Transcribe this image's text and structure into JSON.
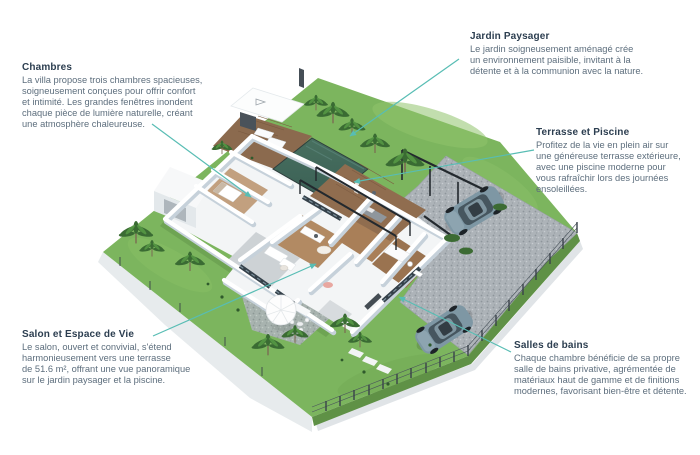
{
  "accent_color": "#58bdb4",
  "heading_color": "#2c3e50",
  "body_color": "#5d6e7d",
  "scene_colors": {
    "grass": "#7cb55e",
    "grass_edge": "#5f9146",
    "gravel": "#adb3b8",
    "pool_water": "#3f665c",
    "deck_wood": "#8b6a4e",
    "house_wall": "#ffffff",
    "glass": "#35414a",
    "car_body": "#7e97a4",
    "cliff": "#e7ebed"
  },
  "annotations": [
    {
      "key": "chambres",
      "title": "Chambres",
      "body": "La villa propose trois chambres spacieuses,\nsoigneusement conçues pour offrir confort\net intimité. Les grandes fenêtres inondent\nchaque pièce de lumière naturelle, créant\nune atmosphère chaleureuse."
    },
    {
      "key": "jardin",
      "title": "Jardin Paysager",
      "body": "Le jardin soigneusement aménagé crée\nun environnement paisible, invitant à la\ndétente et à la communion avec la nature."
    },
    {
      "key": "terrasse",
      "title": "Terrasse et Piscine",
      "body": "Profitez de la vie en plein air sur\nune généreuse terrasse extérieure,\navec une piscine moderne pour\nvous rafraîchir lors des journées\nensoleillées."
    },
    {
      "key": "salon",
      "title": "Salon et Espace de Vie",
      "body": "Le salon, ouvert et convivial, s'étend\nharmonieusement vers une terrasse\nde 51.6 m², offrant une vue panoramique\nsur le jardin paysager et la piscine."
    },
    {
      "key": "salles",
      "title": "Salles de bains",
      "body": "Chaque chambre bénéficie de sa propre\nsalle de bains privative, agrémentée de\nmatériaux haut de gamme et de finitions\nmodernes, favorisant bien-être et détente."
    }
  ]
}
